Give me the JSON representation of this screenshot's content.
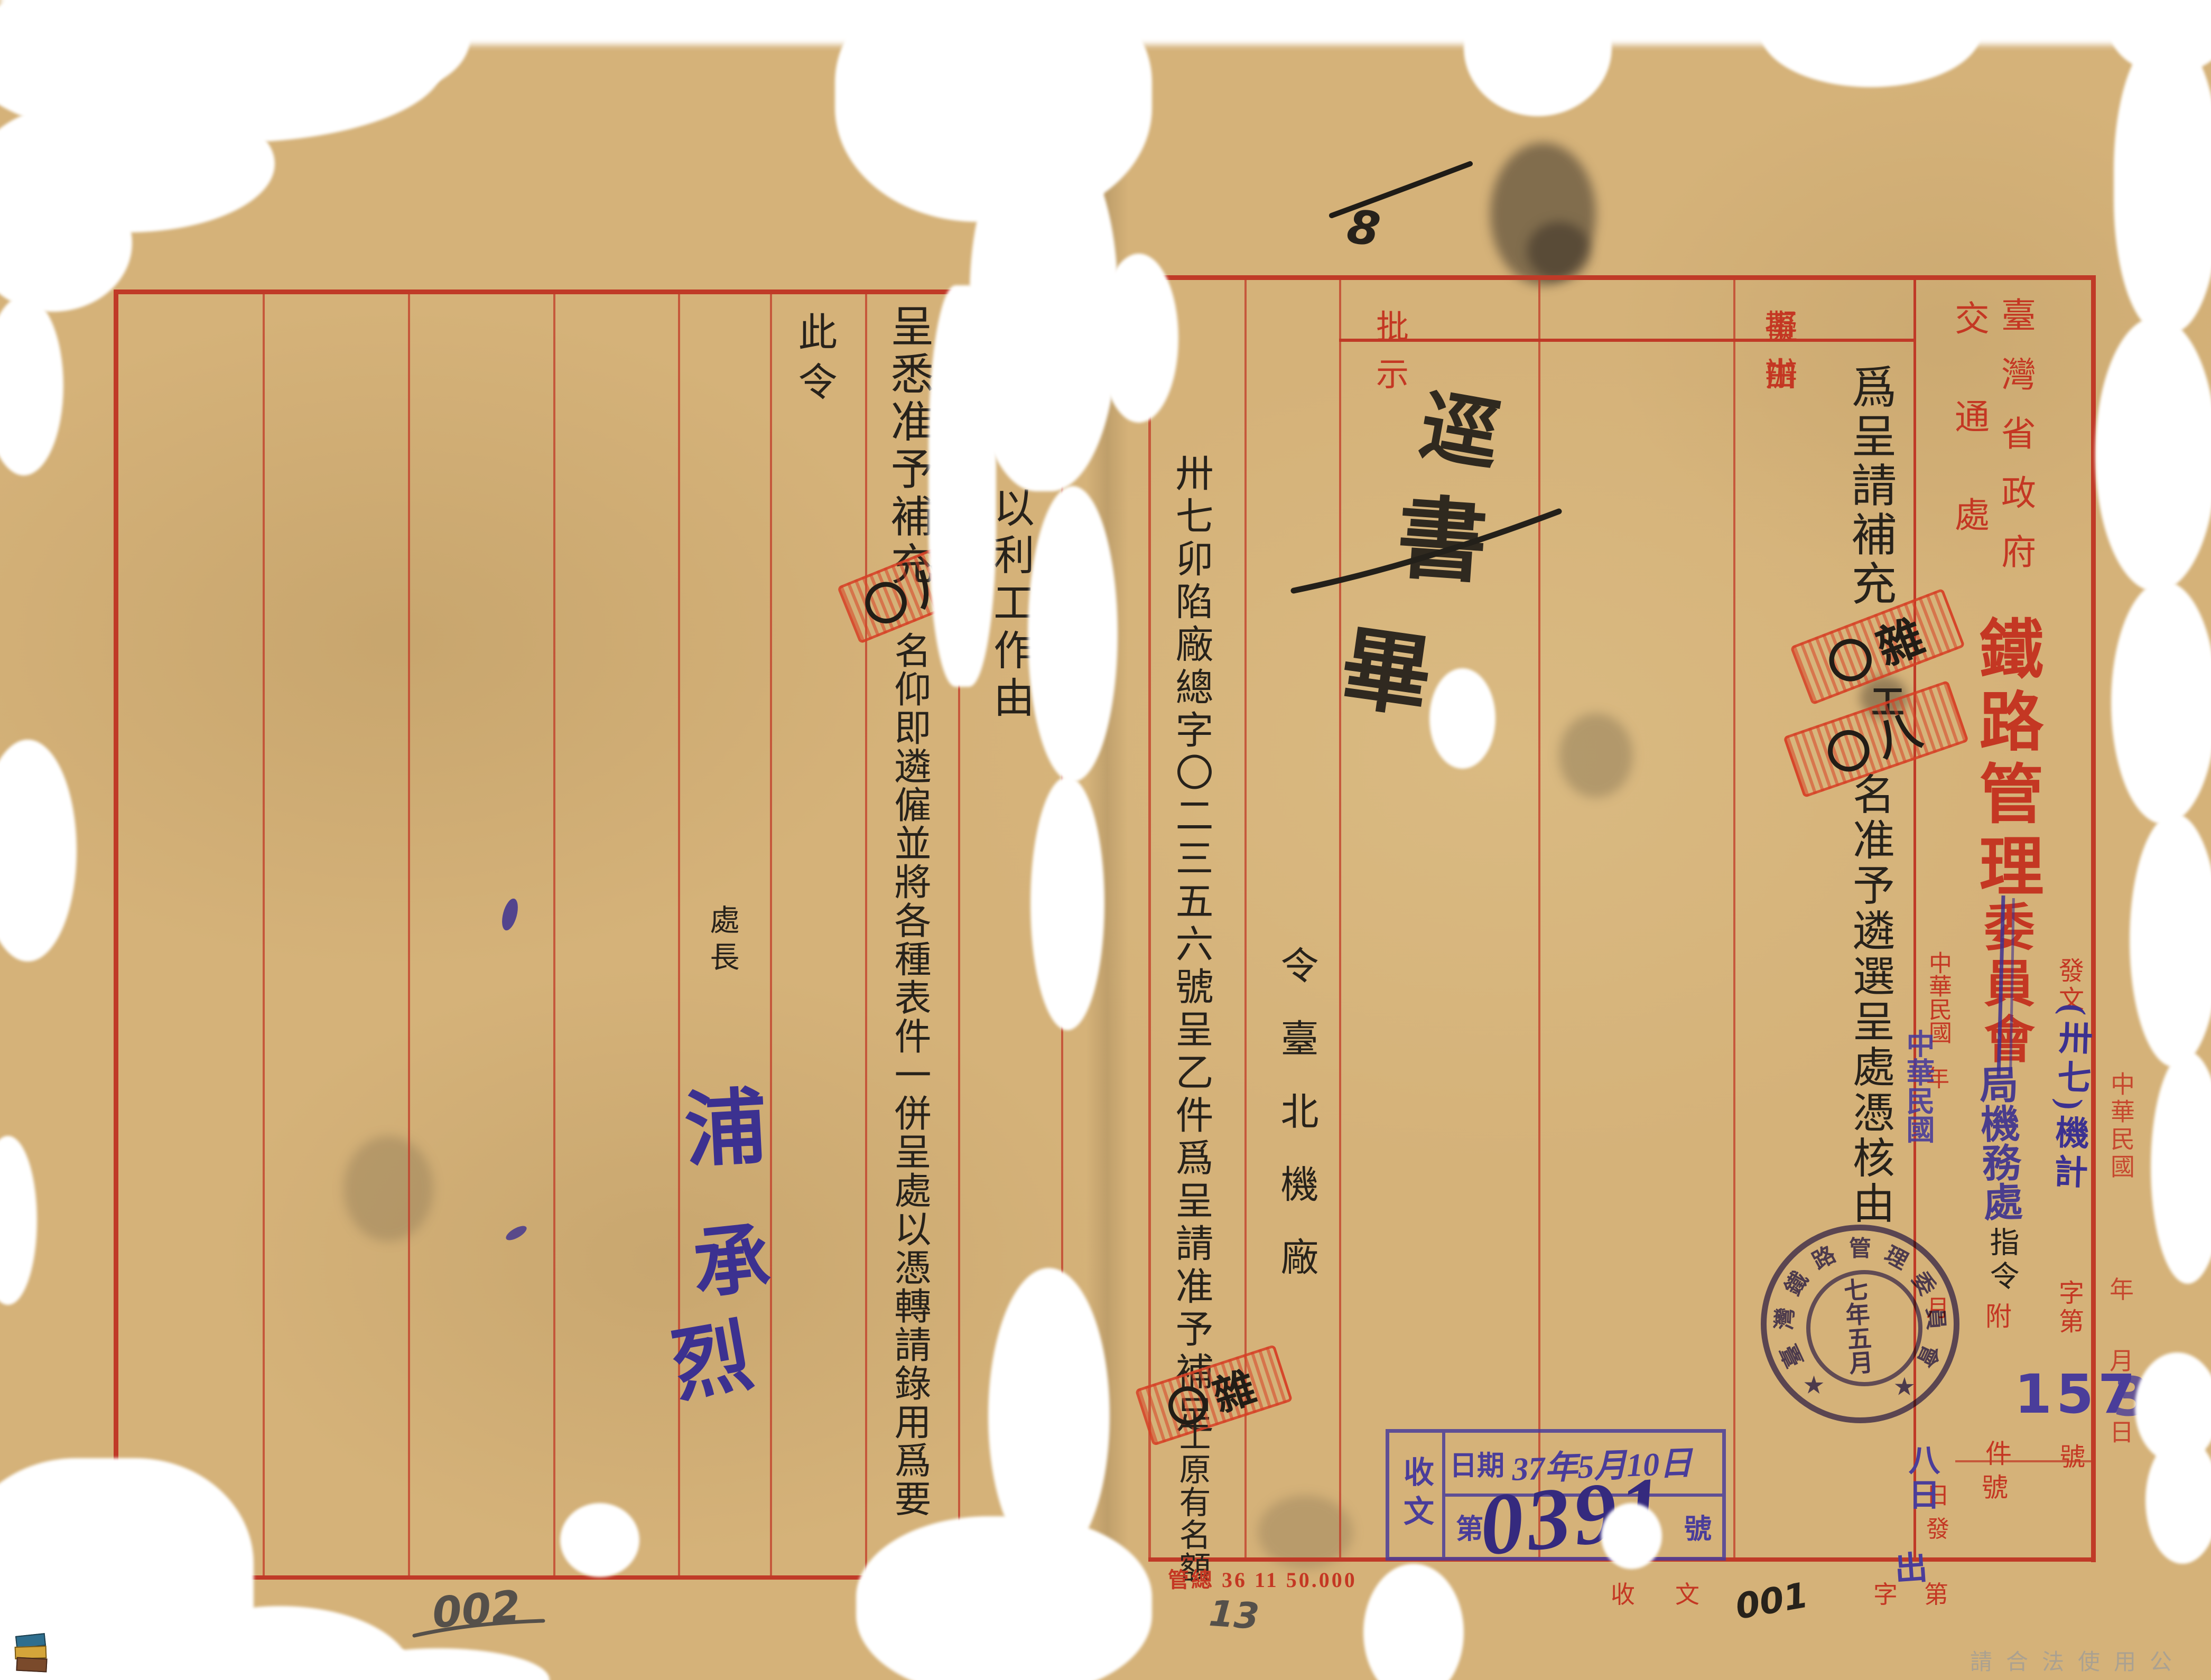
{
  "palette": {
    "paper": "#d5b279",
    "red_print": "#c43723",
    "black_ink": "#27221b",
    "blue_ink": "#3c3190",
    "violet_stamp": "#4a3d9a",
    "red_stamp": "#d94a2e",
    "pencil_gray": "#55504a"
  },
  "watermark": "請合法使用公開之影像",
  "top_annotation": "8",
  "left_page": {
    "reply_part1": "呈悉准予補充",
    "reply_stamp_overlay": "〇八",
    "reply_part2": "名仰即遴僱並將各種表件一併呈處以憑轉請錄用爲要",
    "aim_note": "以利工作由",
    "closing": "此令",
    "signer_title": "處長",
    "signature": [
      "浦",
      "承",
      "烈"
    ],
    "pencil_number": "002"
  },
  "right_page": {
    "header": {
      "subject": "事由",
      "proposal": "擬辦",
      "directive": "批示"
    },
    "subject": {
      "part1": "爲呈請補充",
      "stamp1": "〇雜",
      "mid": "工",
      "stamp2": "〇八",
      "part2": "名准予遴選呈處憑核由"
    },
    "approval": {
      "chars": [
        "逕",
        "書",
        "畢"
      ],
      "dots": "、、"
    },
    "order_line": "令臺北機廠",
    "reference": {
      "part1": "卅七卯陷廠總字〇二三五六號呈乙件爲呈請准予補足",
      "stamp": "〇雜",
      "part2": "工原有名額"
    },
    "letterhead": {
      "gov": "臺灣省政府",
      "dept": "交通處",
      "org_big": "鐵路管理",
      "org_struck": "委員會",
      "correction": "局機務處",
      "doc_type": "指令"
    },
    "dispatch": {
      "label_fa": "發",
      "label_wen": "文",
      "code": "(卅七)機計",
      "zi": "字",
      "di": "第",
      "number": "157",
      "number_tail": "3",
      "hao": "號",
      "fu": "附",
      "jian": "件",
      "hao2": "號"
    },
    "date_col": {
      "roc": "中華民國",
      "year": "年",
      "month": "月",
      "day": "日",
      "fa": "發",
      "blue_roc": "中華民國",
      "blue_day": "八日",
      "blue_chu": "出"
    },
    "right_margin": {
      "roc": "中華民國",
      "year": "年",
      "month": "月",
      "day": "日"
    },
    "seal": {
      "ring": "臺灣鐵路管理委員會",
      "star": "★",
      "inner": "七年五月"
    },
    "receipt": {
      "side": "收文",
      "row1_label": "日期",
      "row1_value": "37年5月10日",
      "row2_label": "第",
      "row2_value": "0391",
      "row2_unit": "號"
    },
    "footer": {
      "print_code": "管總 36 11 50.000",
      "pencil": "13",
      "recv": "收文",
      "hand_number": "001",
      "zidi": "字第"
    }
  }
}
